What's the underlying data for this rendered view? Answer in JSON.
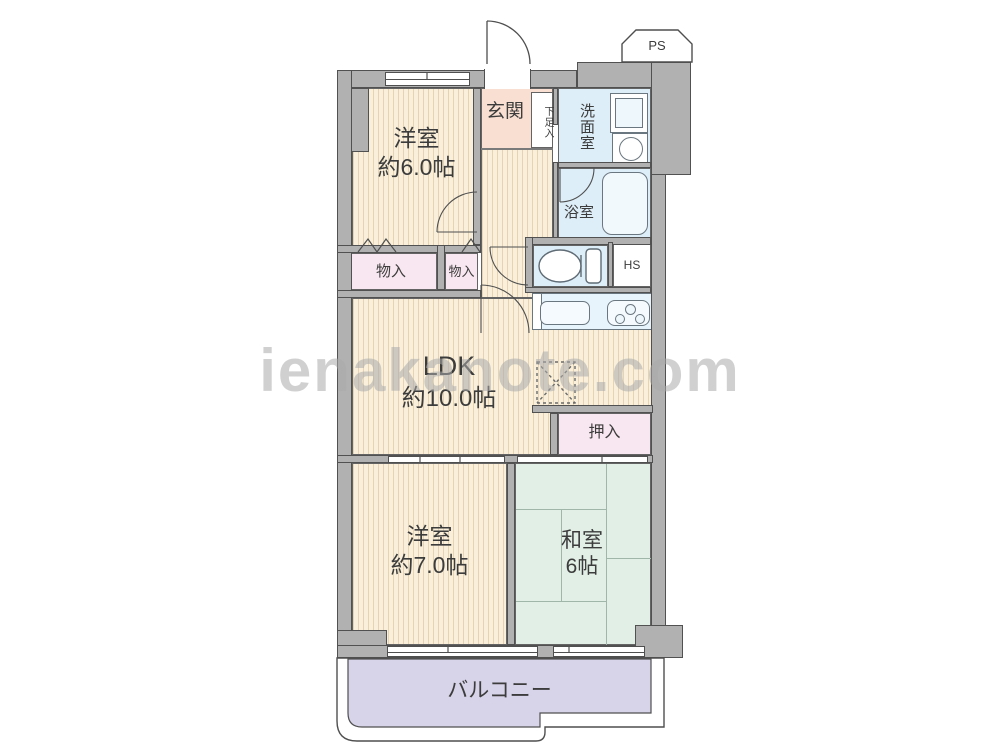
{
  "watermark": "ienakanote.com",
  "rooms": {
    "western1": {
      "name": "洋室",
      "size": "約6.0帖"
    },
    "entrance": {
      "label": "玄関"
    },
    "shoe_cupboard": {
      "label": "下足入"
    },
    "washroom": {
      "label": "洗面室"
    },
    "bathroom": {
      "label": "浴室"
    },
    "storage1": {
      "label": "物入"
    },
    "storage2": {
      "label": "物入"
    },
    "hall_shaft": {
      "label": "HS"
    },
    "ldk": {
      "name": "LDK",
      "size": "約10.0帖"
    },
    "closet": {
      "label": "押入"
    },
    "western2": {
      "name": "洋室",
      "size": "約7.0帖"
    },
    "japanese": {
      "name": "和室",
      "size": "6帖"
    },
    "balcony": {
      "label": "バルコニー"
    },
    "pipe_space": {
      "label": "PS"
    }
  },
  "icons": {
    "bathtub": "bathtub-icon",
    "toilet": "toilet-icon",
    "washbasin": "round-basin-icon",
    "washing_machine": "washing-machine-icon",
    "kitchen_sink": "kitchen-sink-icon",
    "stove": "stove-burners-icon",
    "refrigerator_space": "refrigerator-dashed-box-icon"
  },
  "colors": {
    "wall_gray": "#b1b1b1",
    "room_cream": "#f9efdb",
    "entrance_pink": "#f9dfd2",
    "storage_pink": "#f8e7f0",
    "water_blue": "#ddeef8",
    "tatami_green": "#e2efe6",
    "balcony_lavender": "#d7d3e8",
    "outline": "#4f4f4f"
  }
}
